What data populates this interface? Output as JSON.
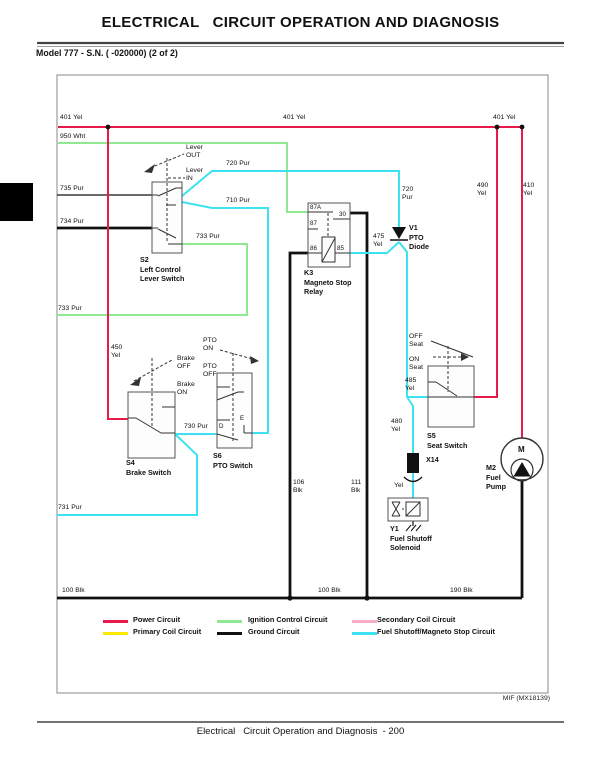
{
  "page": {
    "title": "ELECTRICAL   CIRCUIT OPERATION AND DIAGNOSIS",
    "model_line": "Model 777 - S.N. ( -020000) (2 of 2)",
    "figure_ref": "MIF (MX18139)",
    "footer": "Electrical   Circuit Operation and Diagnosis  - 200"
  },
  "colors": {
    "power": "#e8194b",
    "ignition": "#90e890",
    "secondary": "#f5aec5",
    "primary": "#ffe800",
    "ground": "#111111",
    "fuel_shutoff": "#3ee1f0"
  },
  "diagram": {
    "wire_labels": {
      "yel401_left": "401 Yel",
      "yel401_mid": "401 Yel",
      "yel401_right": "401 Yel",
      "wht950": "950 Wht",
      "pur735": "735 Pur",
      "pur734": "734 Pur",
      "pur733_switch": "733 Pur",
      "pur733_edge": "733 Pur",
      "pur720_top": "720 Pur",
      "pur710": "710 Pur",
      "pur720_diode": "720\nPur",
      "yel475": "475\nYel",
      "yel490": "490\nYel",
      "yel410": "410\nYel",
      "yel450": "450\nYel",
      "pur730": "730 Pur",
      "pur731": "731 Pur",
      "yel485": "485\nYel",
      "yel480": "480\nYel",
      "yel_x14": "Yel",
      "blk106": "106\nBlk",
      "blk111": "111\nBlk",
      "blk100_left": "100 Blk",
      "blk100_mid": "100 Blk",
      "blk190": "190 Blk"
    },
    "components": {
      "s2_label": "S2\nLeft Control\nLever Switch",
      "k3_label": "K3\nMagneto Stop\nRelay",
      "v1_label": "V1\nPTO\nDiode",
      "s4_label": "S4\nBrake Switch",
      "s6_label": "S6\nPTO Switch",
      "s5_label": "S5\nSeat Switch",
      "m2_label": "M2\nFuel\nPump",
      "y1_label": "Y1\nFuel Shutoff\nSolenoid",
      "x14_label": "X14",
      "motor_m": "M"
    },
    "annotations": {
      "lever_out": "Lever\nOUT",
      "lever_in": "Lever\nIN",
      "brake_off": "Brake\nOFF",
      "brake_on": "Brake\nON",
      "pto_on": "PTO\nON",
      "pto_off": "PTO\nOFF",
      "seat_off": "OFF\nSeat",
      "seat_on": "ON\nSeat",
      "term_87a": "87A",
      "term_30": "30",
      "term_87": "87",
      "term_86": "86",
      "term_85": "85",
      "term_d": "D",
      "term_e": "E"
    }
  },
  "legend": {
    "items": [
      {
        "label": "Power Circuit",
        "color": "#e8194b"
      },
      {
        "label": "Ignition Control Circuit",
        "color": "#90e890"
      },
      {
        "label": "Secondary Coil Circuit",
        "color": "#f5aec5"
      },
      {
        "label": "Primary Coil Circuit",
        "color": "#ffe800"
      },
      {
        "label": "Ground Circuit",
        "color": "#111111"
      },
      {
        "label": "Fuel Shutoff/Magneto Stop Circuit",
        "color": "#3ee1f0"
      }
    ]
  }
}
